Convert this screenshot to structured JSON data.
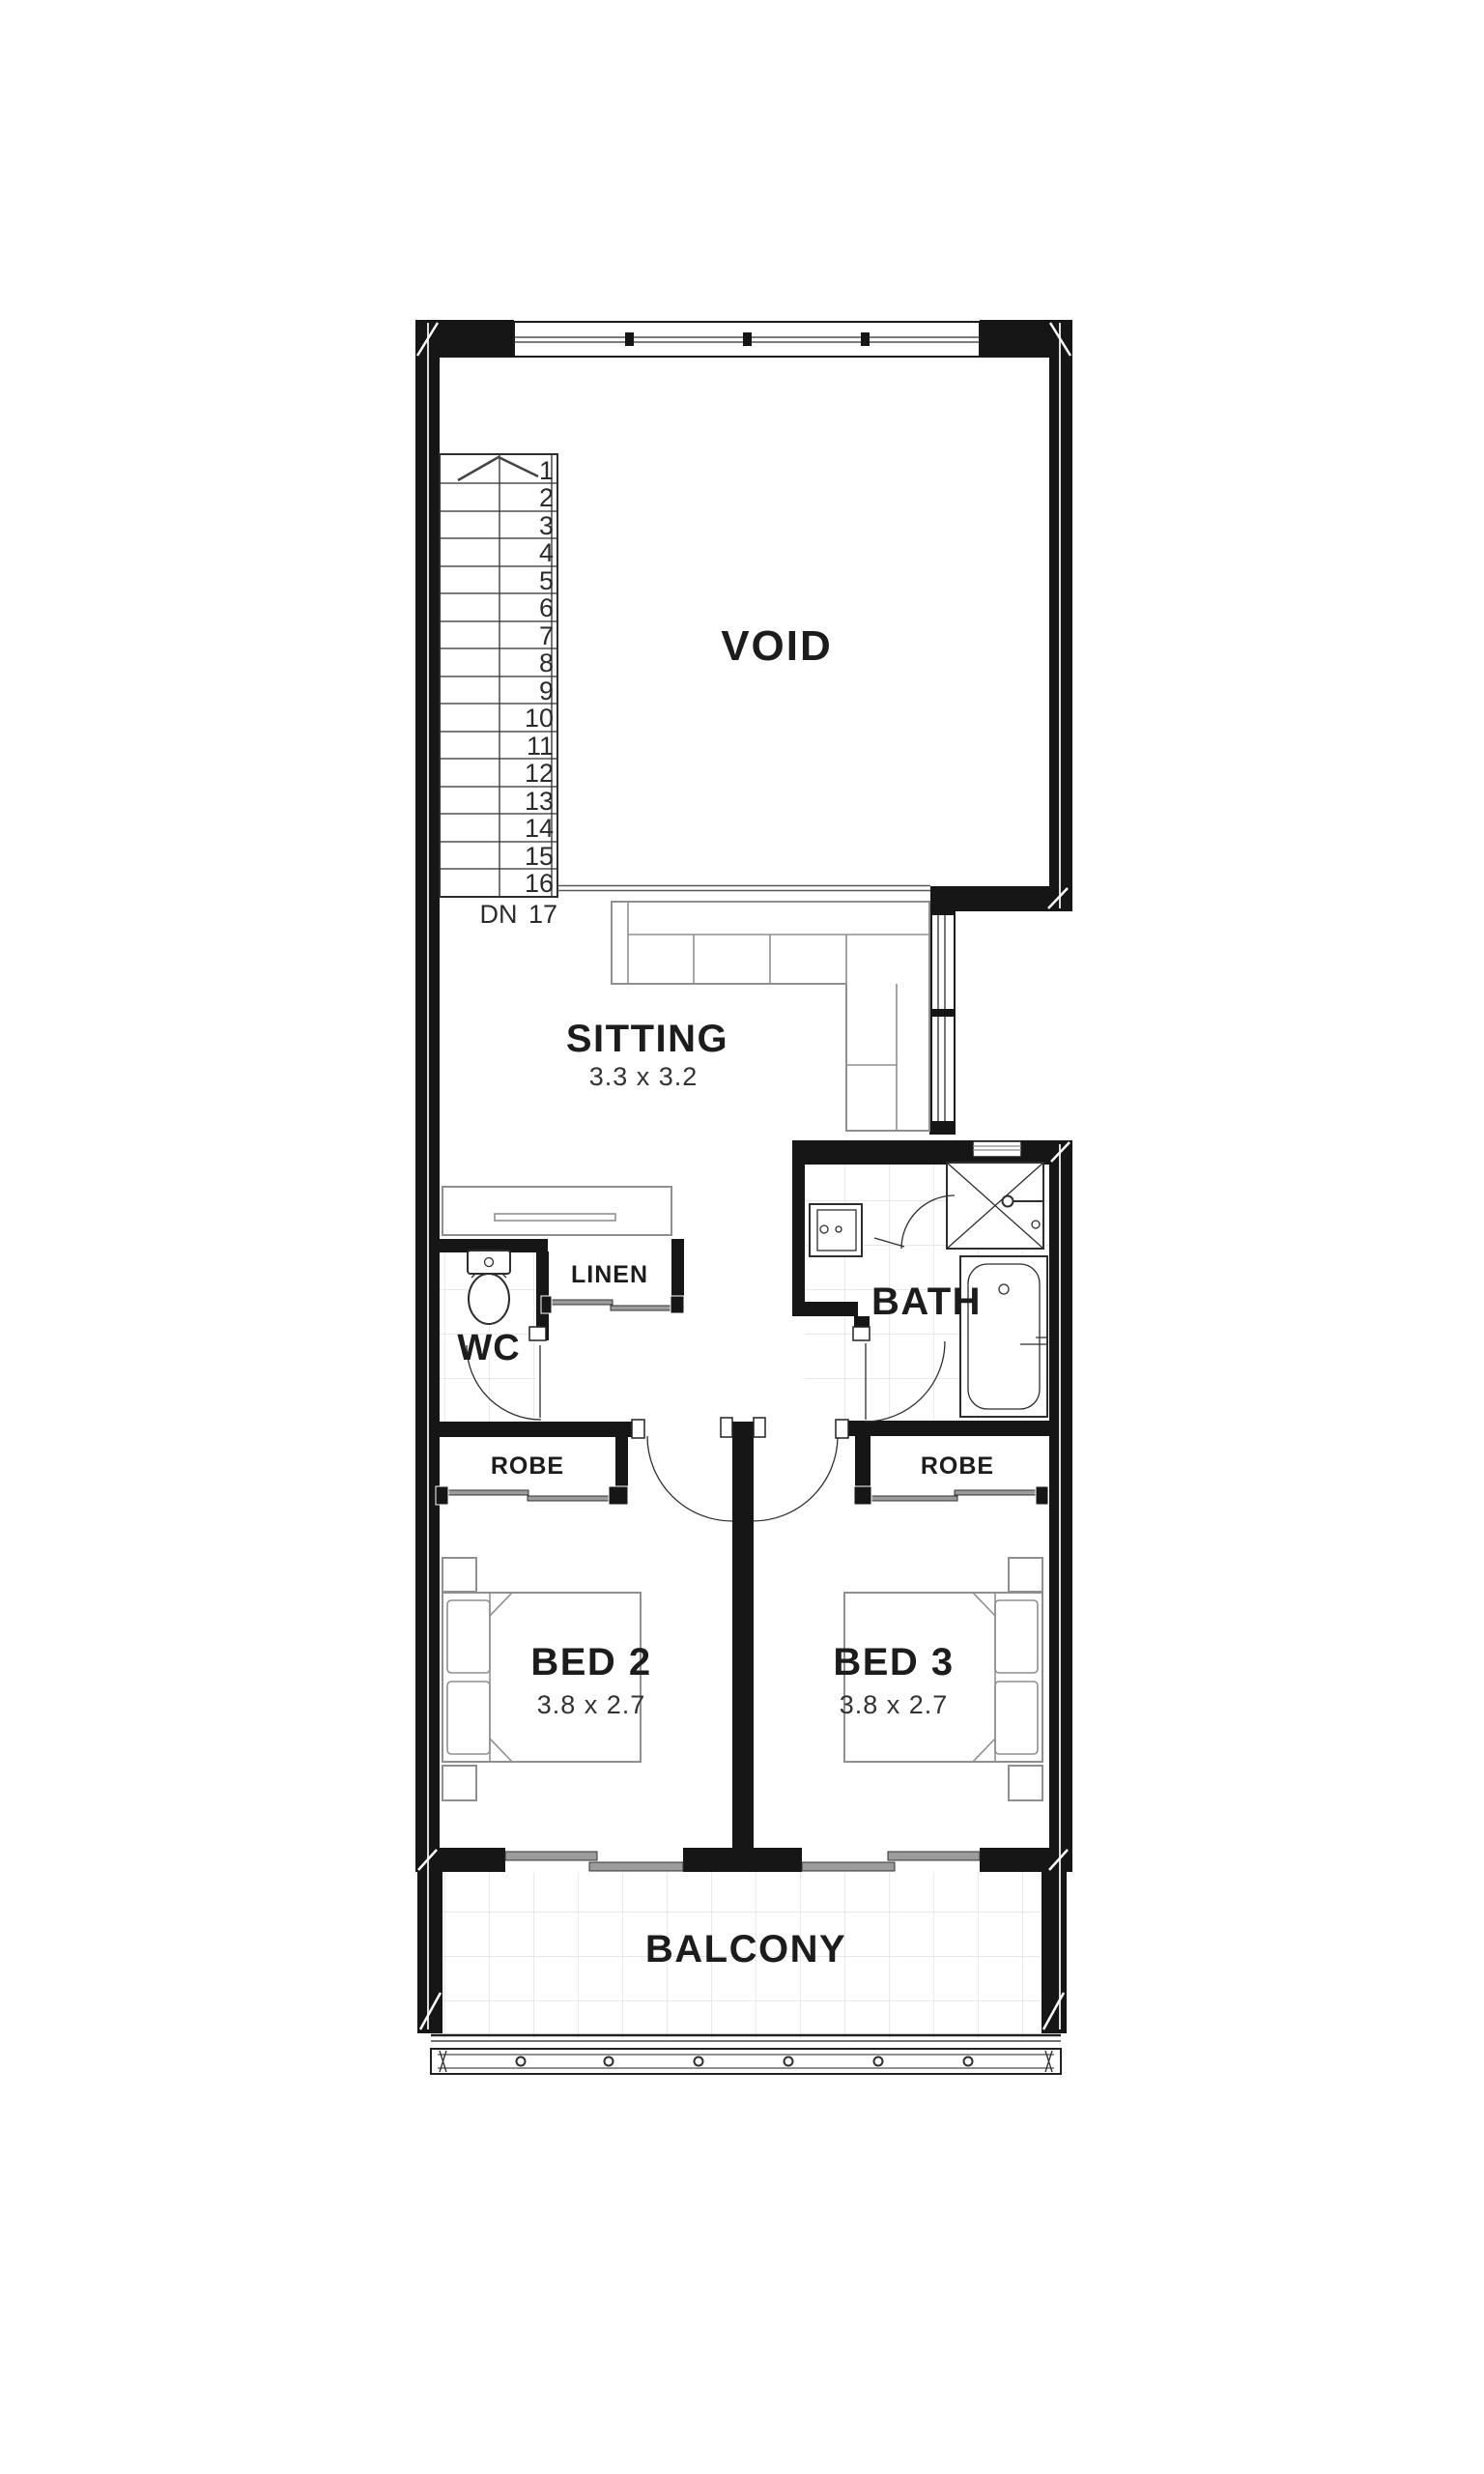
{
  "floorplan": {
    "colors": {
      "wall": "#161616",
      "fixture": "#2e2e2e",
      "furn": "#8f8f8f",
      "track": "#9b9b9b",
      "tile": "#e0e0e0",
      "text": "#1c1c1c",
      "bg": "#ffffff"
    },
    "rooms": {
      "void": {
        "label": "VOID"
      },
      "sitting": {
        "label": "SITTING",
        "dimensions": "3.3 x 3.2"
      },
      "wc": {
        "label": "WC"
      },
      "linen": {
        "label": "LINEN"
      },
      "bath": {
        "label": "BATH"
      },
      "robe_bed2": {
        "label": "ROBE"
      },
      "robe_bed3": {
        "label": "ROBE"
      },
      "bed2": {
        "label": "BED 2",
        "dimensions": "3.8 x 2.7"
      },
      "bed3": {
        "label": "BED 3",
        "dimensions": "3.8 x 2.7"
      },
      "balcony": {
        "label": "BALCONY"
      }
    },
    "stairs": {
      "down_label": "DN",
      "bottom_step": "17",
      "treads": [
        "1",
        "2",
        "3",
        "4",
        "5",
        "6",
        "7",
        "8",
        "9",
        "10",
        "11",
        "12",
        "13",
        "14",
        "15",
        "16"
      ]
    }
  }
}
